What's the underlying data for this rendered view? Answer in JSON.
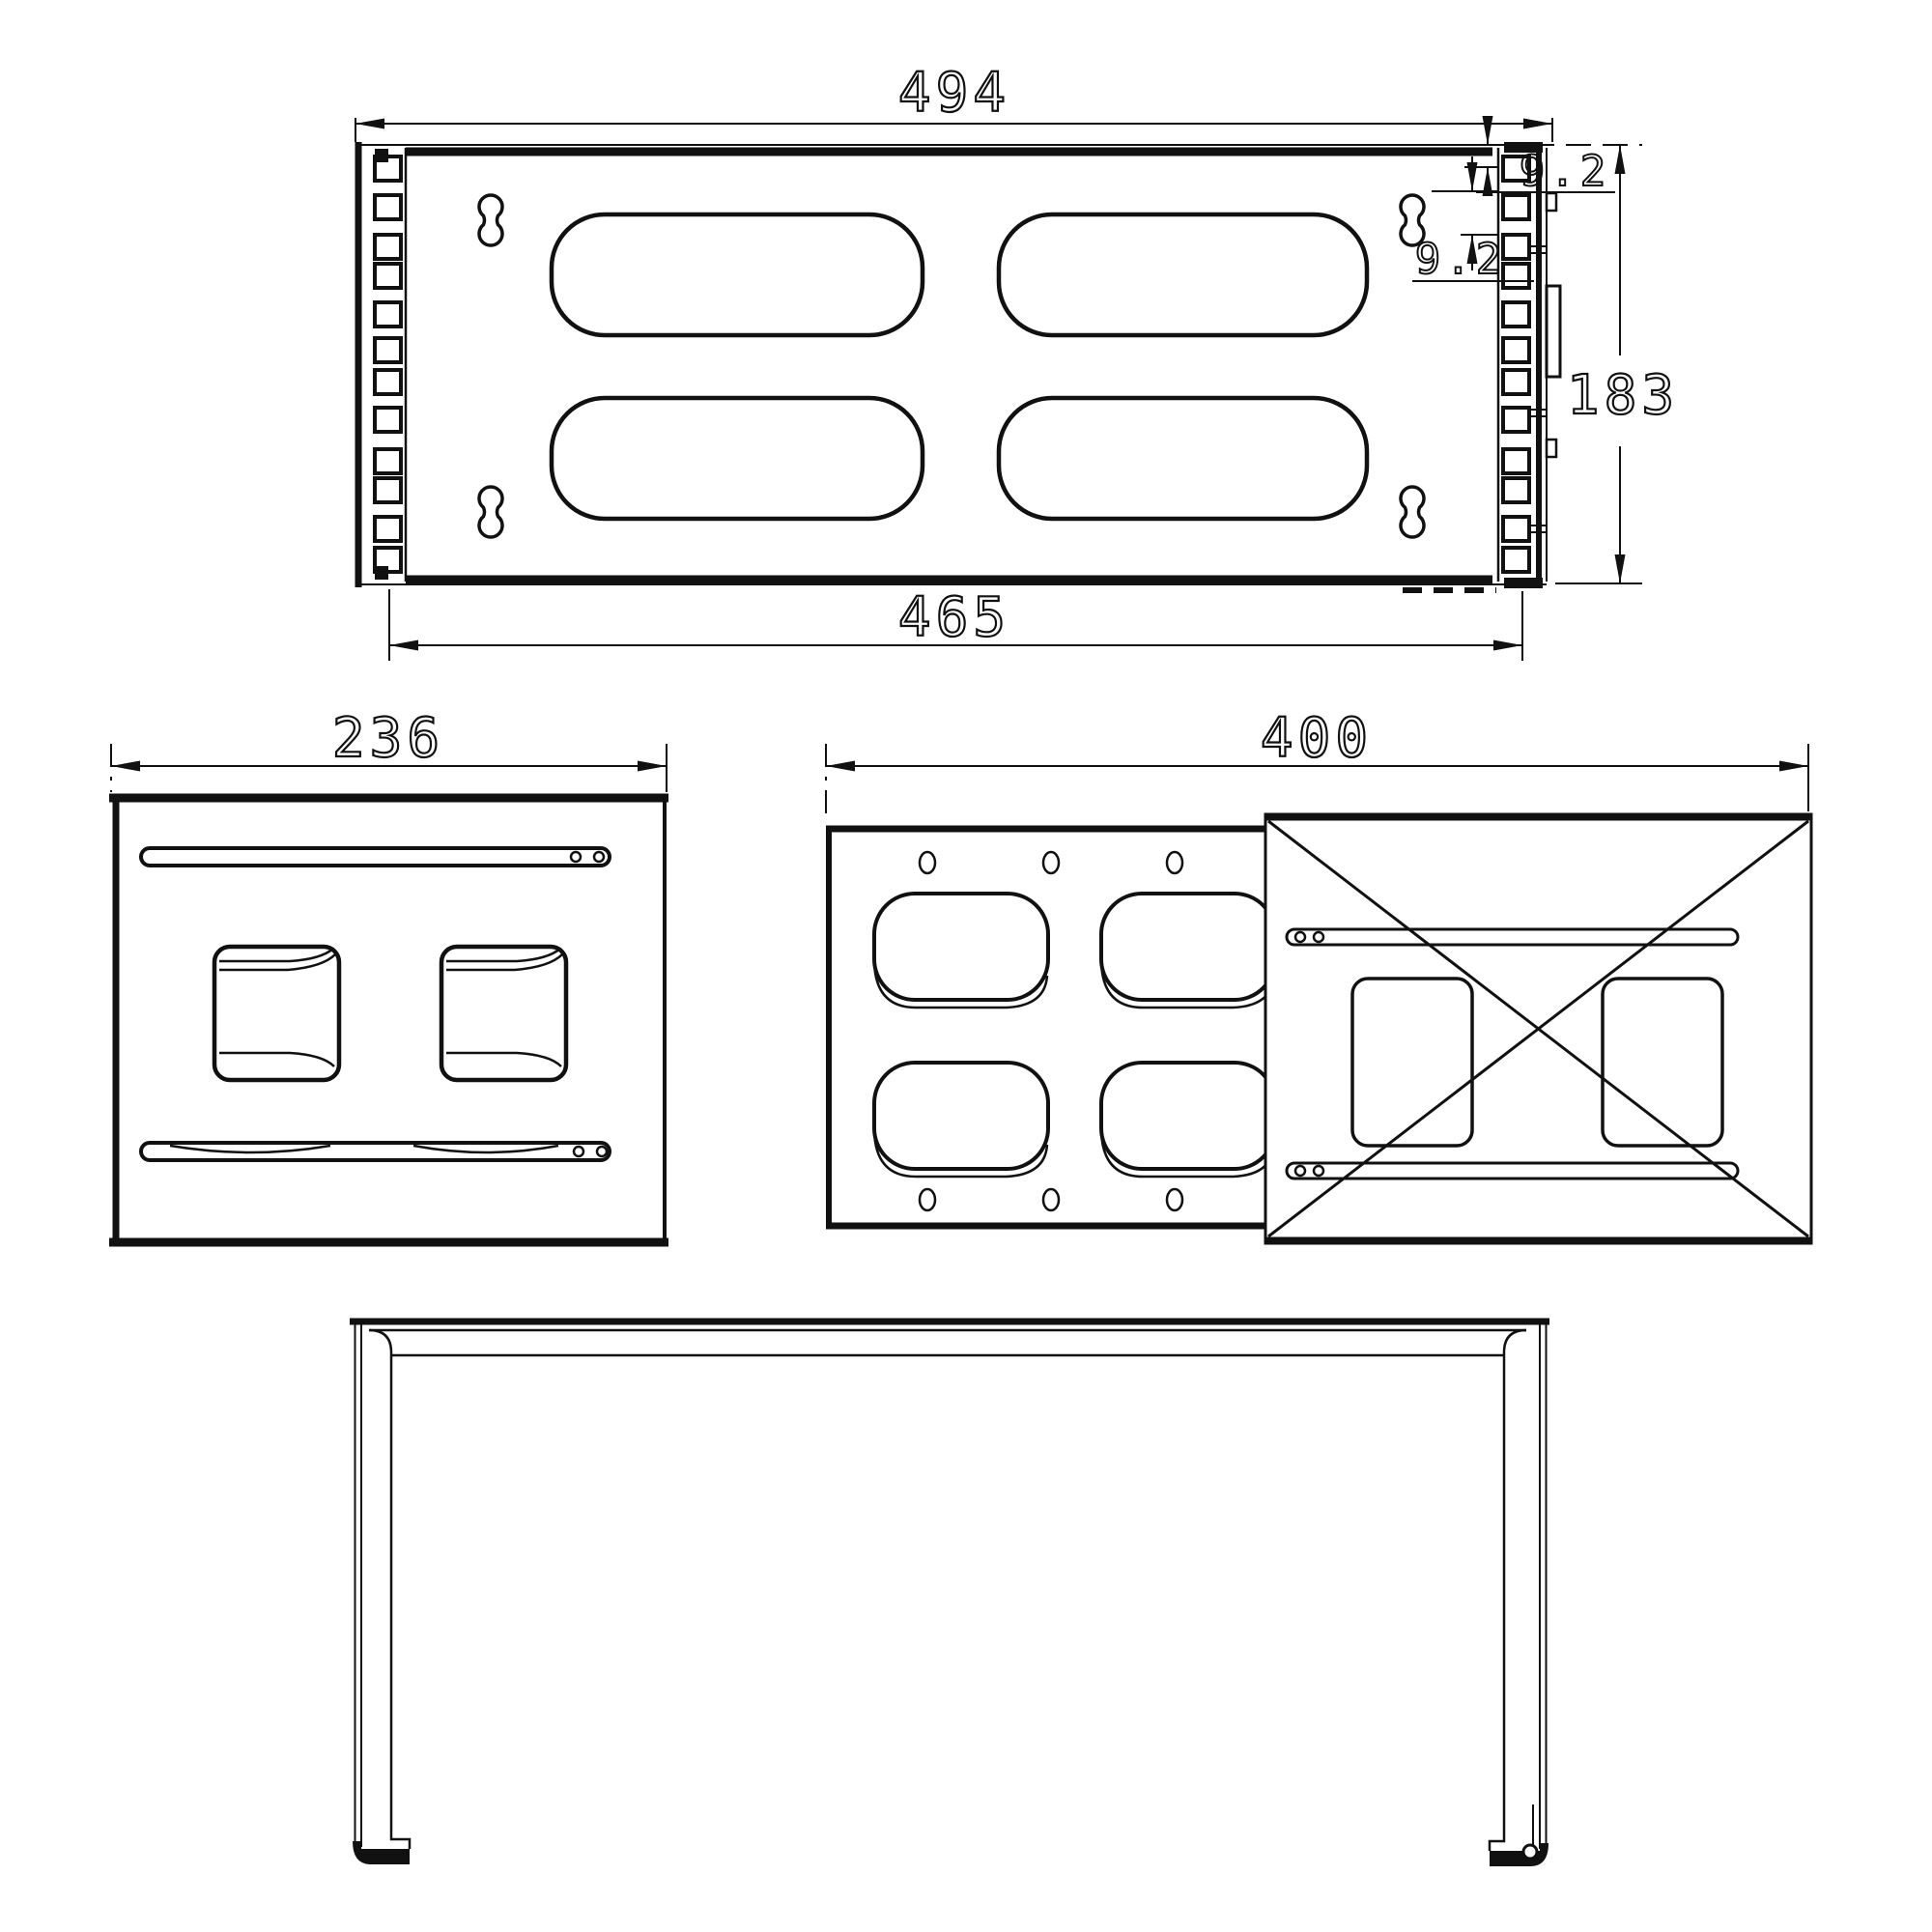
{
  "colors": {
    "background": "#ffffff",
    "line": "#111111"
  },
  "views": {
    "top": {
      "dim_overall_width": "494",
      "dim_mount_width": "465",
      "dim_height": "183",
      "dim_offset_top": "9.2",
      "dim_offset_side": "9.2"
    },
    "side": {
      "dim_depth": "236"
    },
    "back": {
      "dim_depth": "400"
    }
  }
}
